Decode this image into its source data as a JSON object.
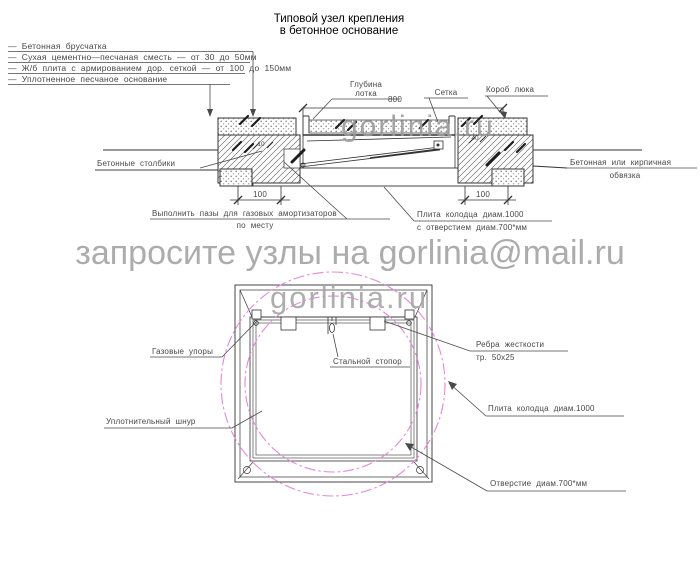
{
  "title": {
    "line1": "Типовой узел крепления",
    "line2": "в бетонное основание"
  },
  "legend": {
    "items": [
      "—  Бетонная брусчатка",
      "—  Сухая цементно—песчаная сместь — от 30 до 50мм",
      "—  Ж/б плита с армированием дор. сеткой — от 100 до 150мм",
      "—  Уплотненное песчаное основание"
    ]
  },
  "section": {
    "depth_label_line1": "Глубина",
    "depth_label_line2": "лотка",
    "dim_800": "800",
    "mesh_label": "Сетка",
    "box_label": "Короб люка",
    "posts_label": "Бетонные столбики",
    "edging_label_line1": "Бетонная или кирпичная",
    "edging_label_line2": "обвязка",
    "grooves_label_line1": "Выполнить пазы для газовых амортизаторов",
    "grooves_label_line2": "по месту",
    "slab_label_line1": "Плита колодца диам.1000",
    "slab_label_line2": "с отверстием диам.700*мм",
    "dim_100_left": "100",
    "dim_100_right": "100",
    "dim_10": "10",
    "dim_40": "40"
  },
  "watermarks": {
    "email": "запросите узлы на gorlinia@mail.ru",
    "site": "gorlinia.ru"
  },
  "plan": {
    "gas_label": "Газовые упоры",
    "stopper_label": "Стальной стопор",
    "ribs_label_line1": "Ребра жесткости",
    "ribs_label_line2": "тр. 50х25",
    "cord_label": "Уплотнительный шнур",
    "slab_label": "Плита колодца диам.1000",
    "opening_label": "Отверстие диам.700*мм"
  },
  "colors": {
    "magenta": "#e687dc",
    "watermark_gray": "#a2a2a2",
    "line": "#333333"
  }
}
